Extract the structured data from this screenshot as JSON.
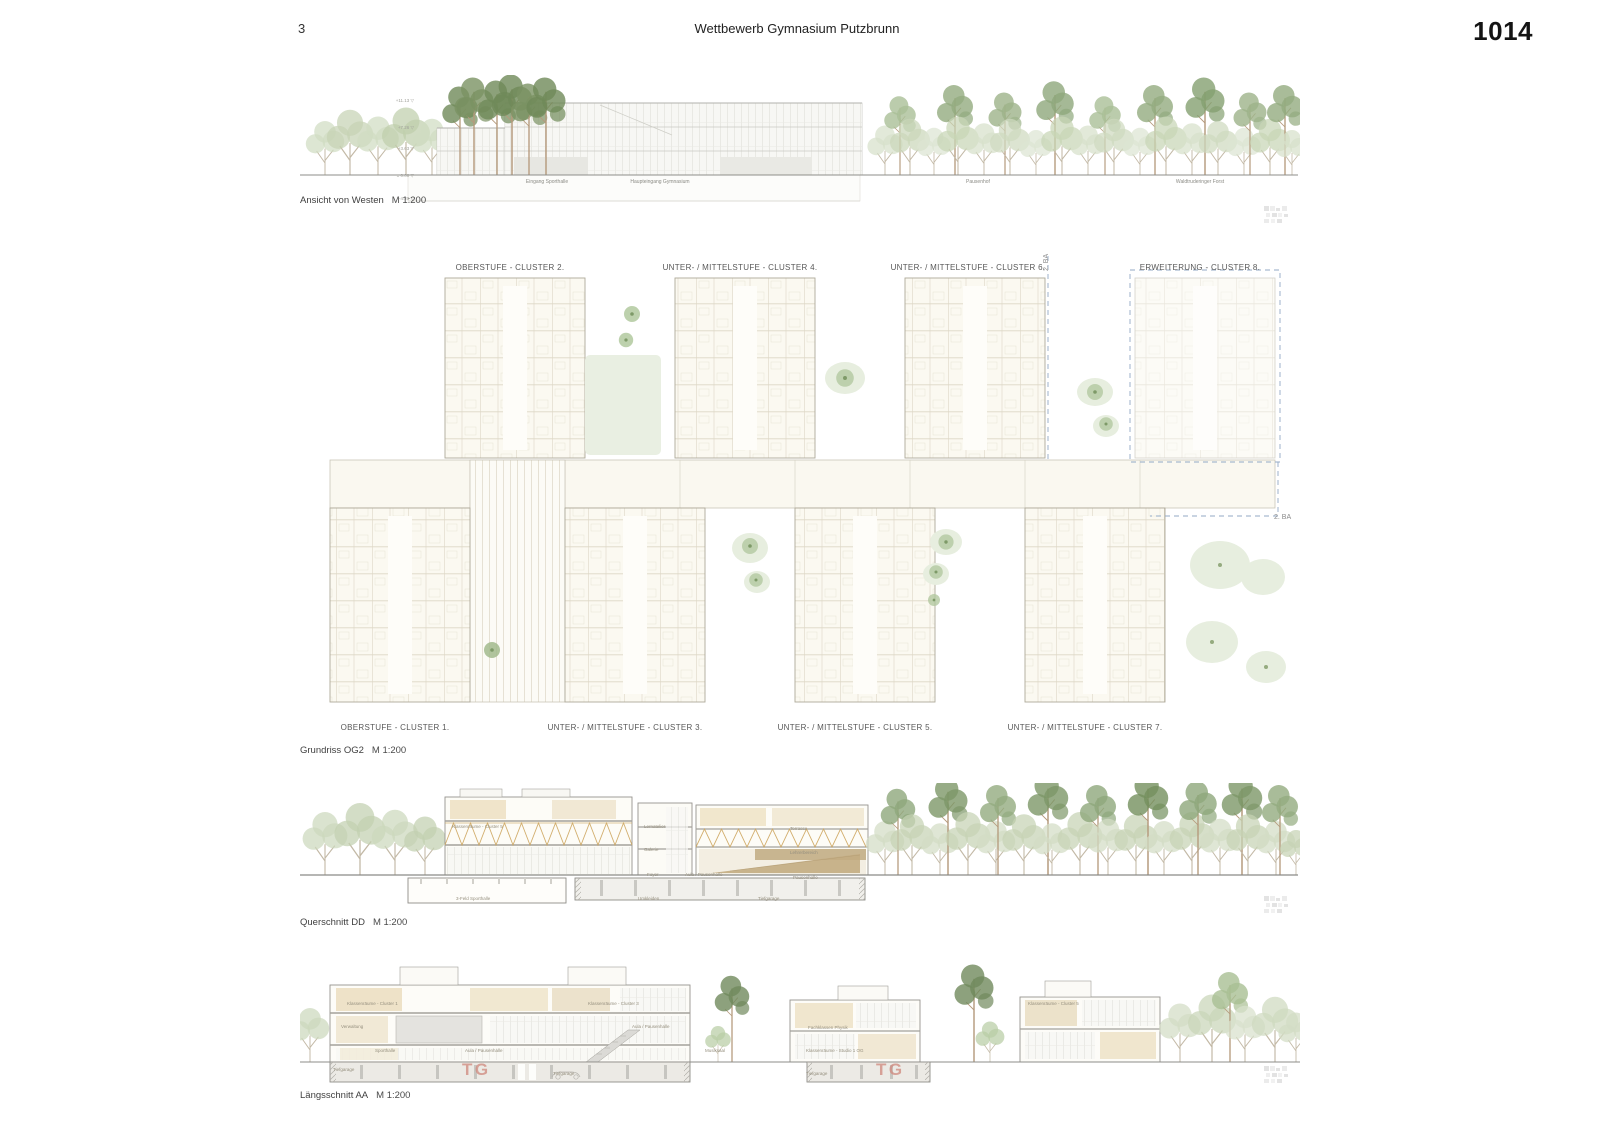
{
  "header": {
    "page_number": "3",
    "title": "Wettbewerb Gymnasium Putzbrunn",
    "entry_number": "1014"
  },
  "elevation": {
    "caption": "Ansicht von Westen",
    "scale": "M 1:200",
    "levels": [
      "+11.13 ▽",
      "+7.26 ▽",
      "+3.63 ▽",
      "± 0.00 ▽",
      "-4.20 ▽"
    ],
    "labels": [
      "Eingang Sporthalle",
      "Haupteingang Gymnasium",
      "Pausenhof",
      "Waldtruderinger Forst"
    ]
  },
  "plan": {
    "caption": "Grundriss OG2",
    "scale": "M 1:200",
    "top_clusters": [
      "OBERSTUFE - CLUSTER 2.",
      "UNTER- / MITTELSTUFE - CLUSTER 4.",
      "UNTER- / MITTELSTUFE - CLUSTER 6.",
      "ERWEITERUNG - CLUSTER 8."
    ],
    "bottom_clusters": [
      "OBERSTUFE - CLUSTER 1.",
      "UNTER- / MITTELSTUFE - CLUSTER 3.",
      "UNTER- / MITTELSTUFE - CLUSTER 5.",
      "UNTER- / MITTELSTUFE - CLUSTER 7."
    ],
    "phase_labels": [
      "2. BA",
      "2. BA"
    ]
  },
  "cross_section": {
    "caption": "Querschnitt DD",
    "scale": "M 1:200",
    "rooms": [
      "Klassenräume - Cluster 5",
      "Lernatelier",
      "Galerie",
      "Foyer",
      "Aula / Pausenhalle",
      "Terrasse",
      "Lehrerbereich",
      "Pausenhalle",
      "3-Feld Sporthalle",
      "Umkleiden",
      "Tiefgarage"
    ]
  },
  "long_section": {
    "caption": "Längsschnitt AA",
    "scale": "M 1:200",
    "rooms": [
      "Klassenräume - Cluster 1",
      "Verwaltung",
      "Sporthalle",
      "Aula / Pausenhalle",
      "Klassenräume - Cluster 3",
      "Aula / Pausenhalle",
      "Musiksaal",
      "Fachklassen Physik",
      "Klassenräume - Studio 1 OG",
      "Klassenräume - Cluster 5"
    ],
    "garage_labels": [
      "Tiefgarage",
      "Tiefgarage",
      "Tiefgarage"
    ],
    "tg_labels": [
      "TG",
      "TG"
    ]
  }
}
